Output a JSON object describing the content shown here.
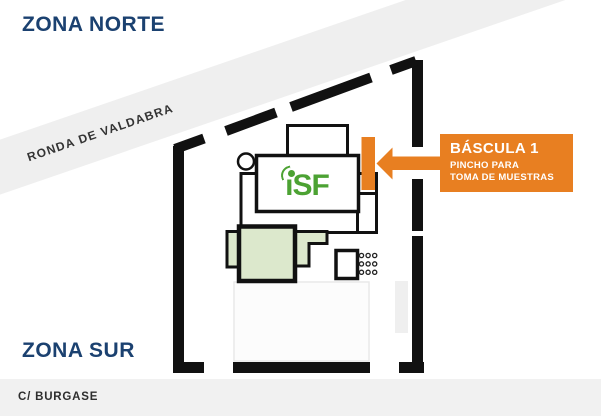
{
  "page": {
    "zona_norte": "ZONA NORTE",
    "zona_sur": "ZONA SUR",
    "road_name": "RONDA DE VALDABRA",
    "street_name": "C/ BURGASE"
  },
  "callout": {
    "title": "BÁSCULA 1",
    "subtitle_line1": "PINCHO PARA",
    "subtitle_line2": "TOMA DE MUESTRAS"
  },
  "logo": {
    "i": "ı",
    "rest": "SF"
  },
  "colors": {
    "navy_text": "#1B4170",
    "orange_accent": "#E87F21",
    "logo_green": "#4CA233",
    "pale_green_fill": "#DCE8CC",
    "road_band_gray": "#EFEFEF",
    "street_band_gray": "#F1F1F1",
    "boundary_black": "#111111"
  }
}
